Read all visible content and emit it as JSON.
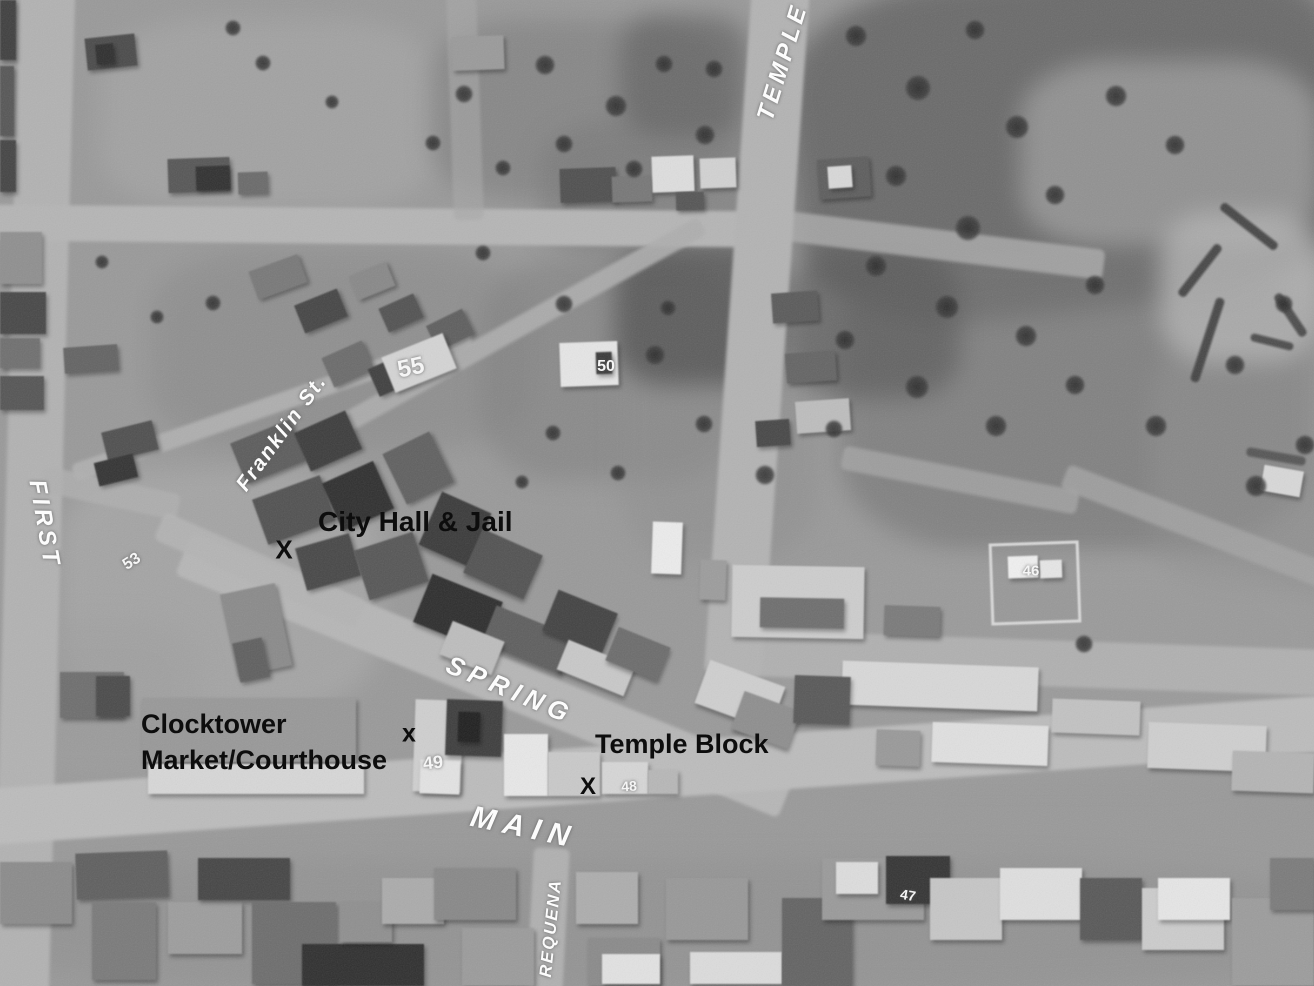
{
  "map": {
    "description_title": "",
    "colors": {
      "photo_base": "#999999",
      "annotation_black": "#0d0d0d",
      "annotation_white": "#fcfcfc"
    },
    "streets": [
      {
        "id": "temple",
        "text": "TEMPLE",
        "x": 783,
        "y": 62,
        "rotate": -73,
        "size": 24,
        "spacing": 4
      },
      {
        "id": "first",
        "text": "FIRST",
        "x": 44,
        "y": 524,
        "rotate": 80,
        "size": 24,
        "spacing": 4
      },
      {
        "id": "franklin",
        "text": "Franklin St.",
        "x": 282,
        "y": 433,
        "rotate": -54,
        "size": 21,
        "spacing": 2
      },
      {
        "id": "spring",
        "text": "SPRING",
        "x": 510,
        "y": 690,
        "rotate": 23,
        "size": 26,
        "spacing": 6
      },
      {
        "id": "main",
        "text": "MAIN",
        "x": 524,
        "y": 828,
        "rotate": 12,
        "size": 30,
        "spacing": 8
      },
      {
        "id": "requena",
        "text": "REQUENA",
        "x": 551,
        "y": 928,
        "rotate": -84,
        "size": 17,
        "spacing": 2
      }
    ],
    "places": [
      {
        "id": "city-hall-jail",
        "lines": [
          "City Hall & Jail"
        ],
        "x": 318,
        "y": 503,
        "size": 28
      },
      {
        "id": "clocktower-market-courthouse",
        "lines": [
          "Clocktower",
          "Market/Courthouse"
        ],
        "x": 141,
        "y": 706,
        "size": 27
      },
      {
        "id": "temple-block",
        "lines": [
          "Temple Block"
        ],
        "x": 595,
        "y": 726,
        "size": 27
      }
    ],
    "markers": [
      {
        "id": "city-hall-jail-x",
        "char": "X",
        "x": 284,
        "y": 550,
        "size": 26
      },
      {
        "id": "clocktower-x",
        "char": "x",
        "x": 409,
        "y": 734,
        "size": 25
      },
      {
        "id": "temple-block-x",
        "char": "X",
        "x": 588,
        "y": 787,
        "size": 24
      }
    ],
    "parcel_numbers": [
      {
        "text": "55",
        "x": 411,
        "y": 368,
        "rotate": -12,
        "size": 24
      },
      {
        "text": "50",
        "x": 606,
        "y": 367,
        "rotate": 0,
        "size": 16
      },
      {
        "text": "53",
        "x": 132,
        "y": 562,
        "rotate": -32,
        "size": 16
      },
      {
        "text": "49",
        "x": 433,
        "y": 763,
        "rotate": -6,
        "size": 18
      },
      {
        "text": "48",
        "x": 629,
        "y": 786,
        "rotate": -4,
        "size": 14
      },
      {
        "text": "46",
        "x": 1031,
        "y": 571,
        "rotate": 0,
        "size": 15
      },
      {
        "text": "47",
        "x": 908,
        "y": 895,
        "rotate": 10,
        "size": 14
      }
    ]
  }
}
